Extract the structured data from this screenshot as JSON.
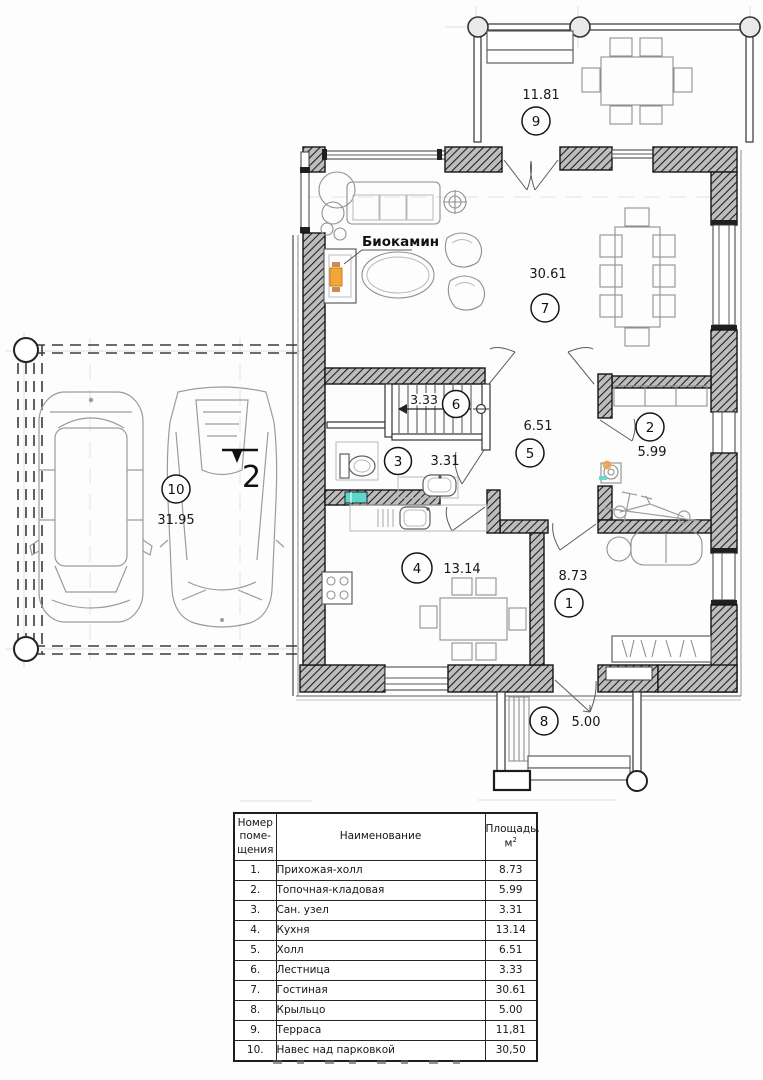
{
  "plan": {
    "fireplace_label": "Биокамин",
    "section_marker": "2",
    "rooms": [
      {
        "num": "1",
        "area": "8.73"
      },
      {
        "num": "2",
        "area": "5.99"
      },
      {
        "num": "3",
        "area": "3.31"
      },
      {
        "num": "4",
        "area": "13.14"
      },
      {
        "num": "5",
        "area": "6.51"
      },
      {
        "num": "6",
        "area": "3.33"
      },
      {
        "num": "7",
        "area": "30.61"
      },
      {
        "num": "8",
        "area": "5.00"
      },
      {
        "num": "9",
        "area": "11.81"
      },
      {
        "num": "10",
        "area": "31.95"
      }
    ]
  },
  "table": {
    "header": {
      "num_lines": [
        "Номер",
        "поме-",
        "щения"
      ],
      "name": "Наименование",
      "area_line1": "Площадь,",
      "area_unit": "м",
      "area_sup": "2"
    },
    "rows": [
      {
        "num": "1.",
        "name": "Прихожая-холл",
        "area": "8.73"
      },
      {
        "num": "2.",
        "name": "Топочная-кладовая",
        "area": "5.99"
      },
      {
        "num": "3.",
        "name": "Сан. узел",
        "area": "3.31"
      },
      {
        "num": "4.",
        "name": "Кухня",
        "area": "13.14"
      },
      {
        "num": "5.",
        "name": "Холл",
        "area": "6.51"
      },
      {
        "num": "6.",
        "name": "Лестница",
        "area": "3.33"
      },
      {
        "num": "7.",
        "name": "Гостиная",
        "area": "30.61"
      },
      {
        "num": "8.",
        "name": "Крыльцо",
        "area": "5.00"
      },
      {
        "num": "9.",
        "name": "Терраса",
        "area": "11,81"
      },
      {
        "num": "10.",
        "name": "Навес над парковкой",
        "area": "30,50"
      }
    ]
  }
}
